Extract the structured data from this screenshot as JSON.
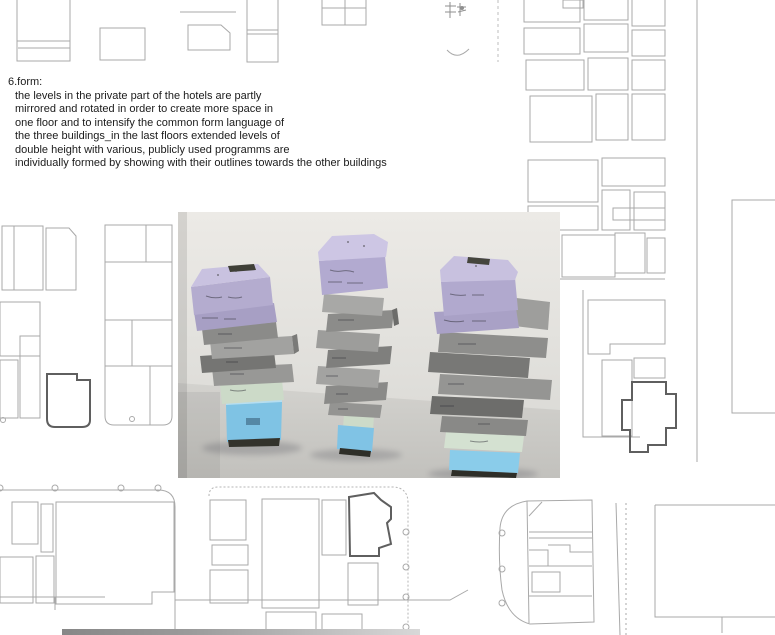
{
  "page": {
    "background": "#ffffff",
    "section_heading": "6.form:",
    "body_lines": [
      "the levels in the private part of the hotels are partly",
      "mirrored and rotated in order to create more space in",
      "one floor and to intensify the common form language of",
      "the three buildings_in the last floors extended levels of",
      "double height with various, publicly used programms are",
      "individually formed by showing with their outlines towards the other buildings"
    ]
  },
  "site_plan": {
    "description": "faint figure-ground site plan of city blocks with three bold-outlined project buildings, tree circles and dashed street lines",
    "line_color": "#a9a9a9",
    "highlight_line_color": "#5f5f5f",
    "street_bar_color": "#949494"
  },
  "photo": {
    "description": "photograph of three stacked foam massing models with handwritten level labels",
    "wall_color": "#e6e5e1",
    "floor_color": "#c9c8c4",
    "block_colors": {
      "purple_top": "#c9c2e0",
      "purple_front": "#b2aad0",
      "gray_light": "#a3a3a1",
      "gray_dark": "#6f6f6d",
      "green": "#cfdecb",
      "blue": "#82c4e4"
    }
  }
}
